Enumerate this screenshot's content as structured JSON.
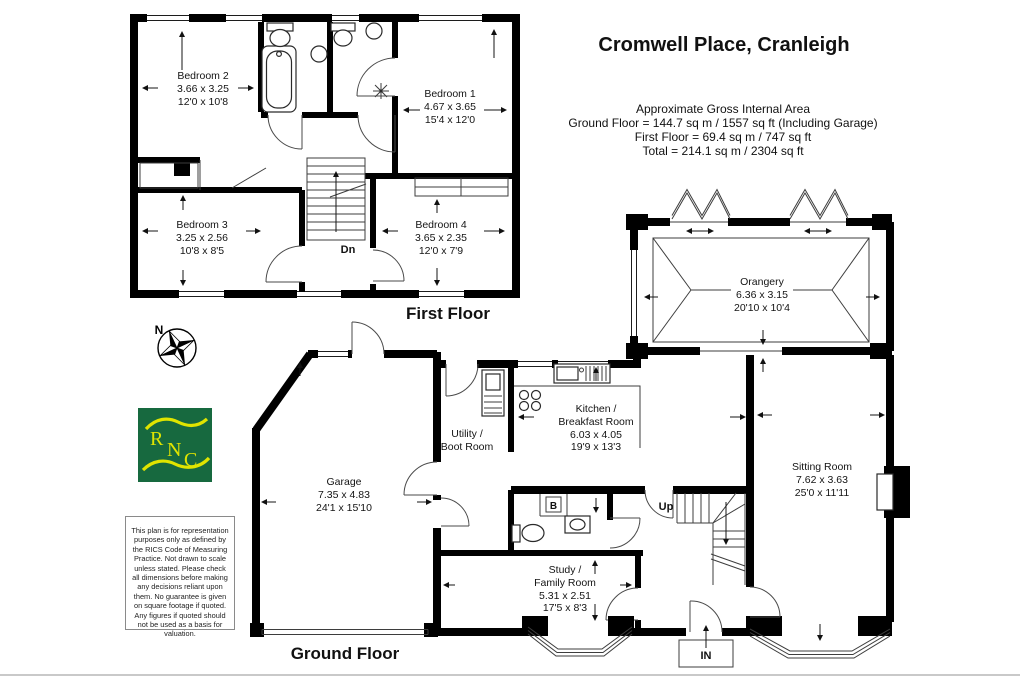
{
  "title": "Cromwell Place, Cranleigh",
  "area_summary": {
    "heading": "Approximate Gross Internal Area",
    "ground_floor": "Ground Floor = 144.7 sq m / 1557 sq ft (Including Garage)",
    "first_floor": "First Floor = 69.4 sq m / 747 sq ft",
    "total": "Total = 214.1 sq m / 2304 sq ft"
  },
  "first_floor": {
    "caption": "First Floor",
    "stairs_label": "Dn",
    "rooms": {
      "bedroom1": {
        "name": "Bedroom 1",
        "metric": "4.67 x 3.65",
        "imperial": "15'4 x 12'0"
      },
      "bedroom2": {
        "name": "Bedroom 2",
        "metric": "3.66 x 3.25",
        "imperial": "12'0 x 10'8"
      },
      "bedroom3": {
        "name": "Bedroom 3",
        "metric": "3.25 x 2.56",
        "imperial": "10'8 x 8'5"
      },
      "bedroom4": {
        "name": "Bedroom 4",
        "metric": "3.65 x 2.35",
        "imperial": "12'0 x 7'9"
      }
    }
  },
  "ground_floor": {
    "caption": "Ground Floor",
    "stairs_label": "Up",
    "entrance_label": "IN",
    "boiler_label": "B",
    "rooms": {
      "orangery": {
        "name": "Orangery",
        "metric": "6.36 x 3.15",
        "imperial": "20'10 x 10'4"
      },
      "kitchen": {
        "name": "Kitchen /\nBreakfast Room",
        "metric": "6.03 x 4.05",
        "imperial": "19'9 x 13'3"
      },
      "sitting_room": {
        "name": "Sitting Room",
        "metric": "7.62 x 3.63",
        "imperial": "25'0 x 11'11"
      },
      "garage": {
        "name": "Garage",
        "metric": "7.35 x 4.83",
        "imperial": "24'1 x 15'10"
      },
      "utility": {
        "name": "Utility /\nBoot Room"
      },
      "study": {
        "name": "Study /\nFamily Room",
        "metric": "5.31 x 2.51",
        "imperial": "17'5 x 8'3"
      }
    }
  },
  "compass": {
    "north_label": "N"
  },
  "logo": {
    "letters": [
      "R",
      "N",
      "C"
    ],
    "background": "#17693f",
    "accent": "#e0e400"
  },
  "colors": {
    "walls": "#000000",
    "background": "#ffffff",
    "footer_rule": "#c9c9c9"
  },
  "disclaimer": "This plan is for representation purposes only as defined by the RICS Code of Measuring Practice. Not drawn to scale unless stated. Please check all dimensions before making any decisions reliant upon them. No guarantee is given on square footage if quoted. Any figures if quoted should not be used as a basis for valuation."
}
